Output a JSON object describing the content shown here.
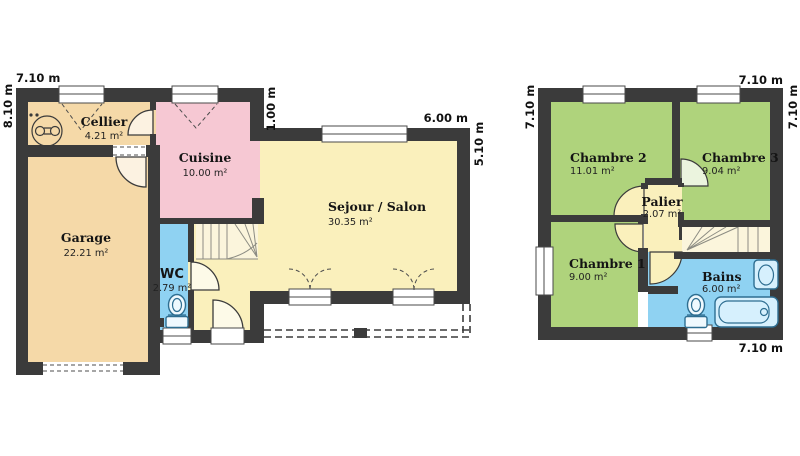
{
  "colors": {
    "wall": "#3B3B3B",
    "garage_cellier_fill": "#F5D9A8",
    "cuisine_fill": "#F6C8D3",
    "living_fill": "#FAF0BC",
    "water_room_fill": "#8FD2F2",
    "bedroom_fill": "#AFD37C",
    "stair_fill": "#FBF5DC",
    "background": "#FFFFFF"
  },
  "ground_floor": {
    "rooms": {
      "cellier": {
        "name": "Cellier",
        "area": "4.21 m²"
      },
      "cuisine": {
        "name": "Cuisine",
        "area": "10.00 m²"
      },
      "garage": {
        "name": "Garage",
        "area": "22.21 m²"
      },
      "wc": {
        "name": "WC",
        "area": "2.79 m²"
      },
      "sejour": {
        "name": "Sejour / Salon",
        "area": "30.35 m²"
      }
    },
    "dimensions": {
      "top": "7.10 m",
      "left": "8.10 m",
      "offset": "1.00 m",
      "sejour_top": "6.00 m",
      "sejour_right": "5.10 m"
    }
  },
  "upper_floor": {
    "rooms": {
      "chambre2": {
        "name": "Chambre 2",
        "area": "11.01 m²"
      },
      "chambre3": {
        "name": "Chambre 3",
        "area": "9.04 m²"
      },
      "chambre1": {
        "name": "Chambre 1",
        "area": "9.00 m²"
      },
      "palier": {
        "name": "Palier",
        "area": "2.07 m²"
      },
      "bains": {
        "name": "Bains",
        "area": "6.00 m²"
      }
    },
    "dimensions": {
      "left": "7.10 m",
      "top_right": "7.10 m",
      "right": "7.10 m",
      "bottom_right": "7.10 m"
    }
  }
}
